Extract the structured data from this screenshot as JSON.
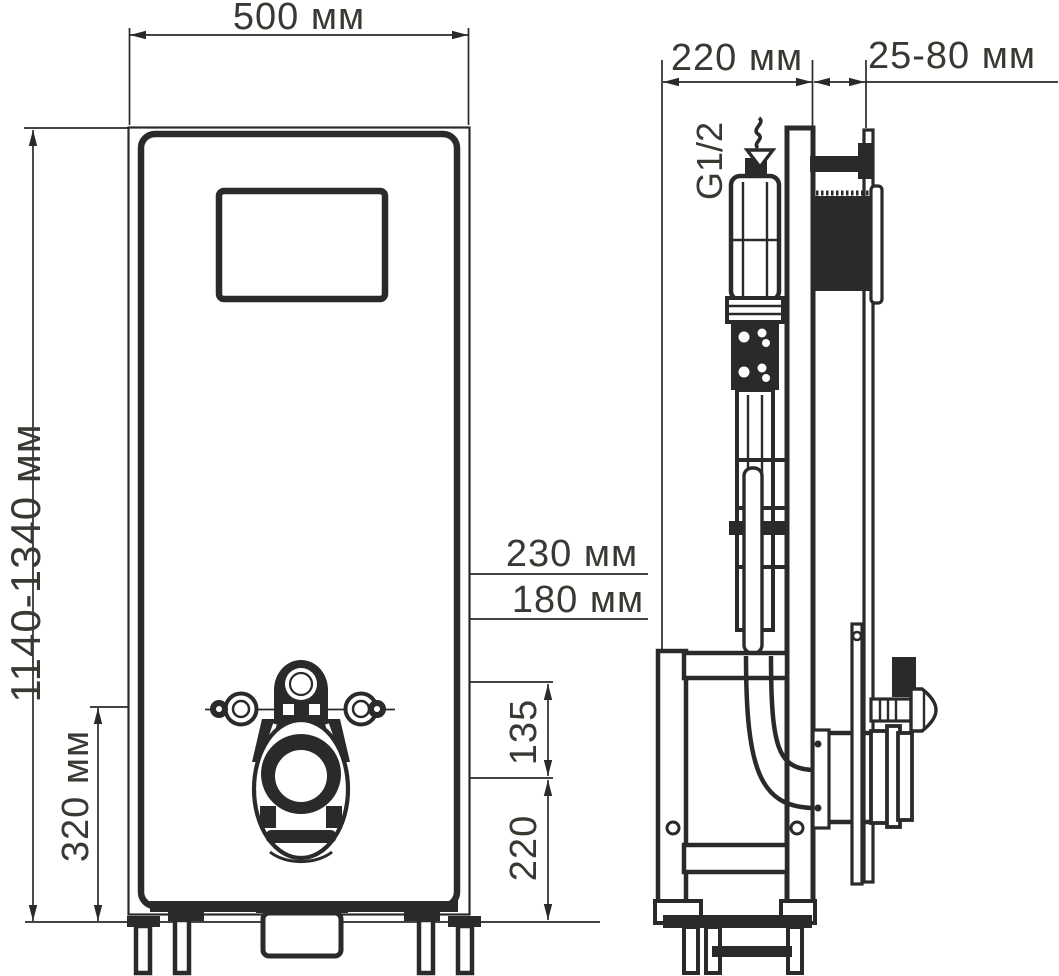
{
  "drawing": {
    "front_view": {
      "width_label": "500 мм",
      "height_label": "1140-1340 мм",
      "outer_fixing_span_label": "230 мм",
      "fixing_span_label": "180 мм",
      "lower_zone_label": "320 мм",
      "inlet_to_outlet_label": "135",
      "outlet_height_label": "220"
    },
    "side_view": {
      "depth_label": "220 мм",
      "wall_clearance_label": "25-80 мм",
      "thread_label": "G1/2"
    }
  },
  "colors": {
    "ink": "#2b2a28",
    "text": "#3a3832",
    "background": "#ffffff"
  }
}
